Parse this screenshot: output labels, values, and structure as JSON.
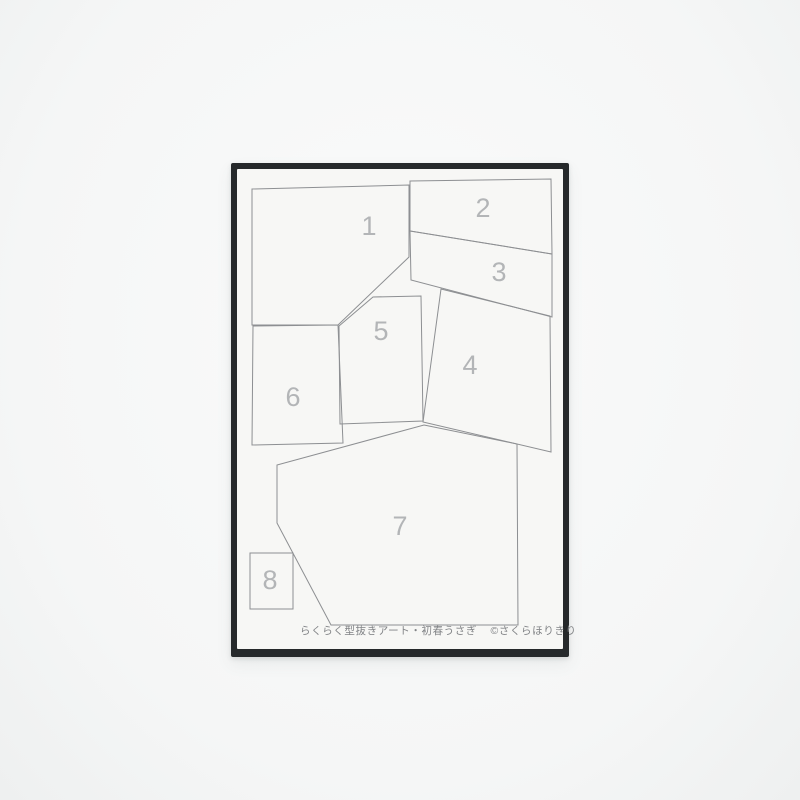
{
  "photo": {
    "background_color": "#f5f6f6",
    "card": {
      "frame_color": "#26292b",
      "paper_color": "#f7f7f5",
      "outline_color": "#8d8f92",
      "number_color": "#b3b5b7",
      "footer_color": "#818386",
      "footer": {
        "product_name": "らくらく型抜きアート・初春うさぎ",
        "copyright": "©さくらほりきり"
      },
      "regions": [
        {
          "number": "1",
          "points": "252,189 409,185 409,257 338,325 252,325",
          "label_x": 369,
          "label_y": 226
        },
        {
          "number": "2",
          "points": "410,181 551,179 552,254 410,231",
          "label_x": 483,
          "label_y": 208
        },
        {
          "number": "3",
          "points": "410,231 552,254 552,317 411,280",
          "label_x": 499,
          "label_y": 272
        },
        {
          "number": "4",
          "points": "441,289 550,316 551,452 423,422",
          "label_x": 470,
          "label_y": 365
        },
        {
          "number": "5",
          "points": "339,326 373,297 421,296 423,421 340,424",
          "label_x": 381,
          "label_y": 331
        },
        {
          "number": "6",
          "points": "253,326 338,325 343,443 252,445",
          "label_x": 293,
          "label_y": 397
        },
        {
          "number": "7",
          "points": "424,425 517,444 518,625 331,625 277,523 277,465",
          "label_x": 400,
          "label_y": 526
        },
        {
          "number": "8",
          "points": "250,553 293,553 293,609 250,609",
          "label_x": 270,
          "label_y": 580
        }
      ]
    }
  }
}
